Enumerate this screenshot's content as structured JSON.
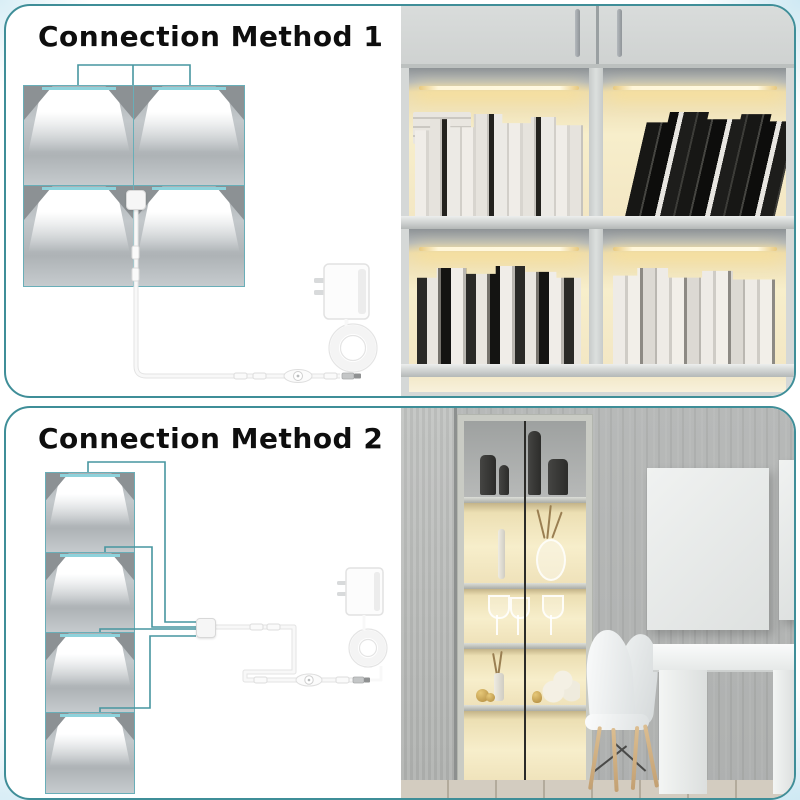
{
  "page": {
    "accent_teal": "#3f8e98",
    "wire_teal": "#4796a0",
    "led_cyan": "#8ed2db",
    "warm_light": "#f7eecb",
    "title_color": "#0e0e0e"
  },
  "sections": [
    {
      "id": "method-1",
      "title": "Connection Method 1",
      "diagram": {
        "panel_count": 4,
        "arrangement": "2x2 grid",
        "components": [
          "light panel x4",
          "4-way splitter",
          "extension cable",
          "inline switch",
          "coiled cable",
          "wall power adapter"
        ]
      }
    },
    {
      "id": "method-2",
      "title": "Connection Method 2",
      "diagram": {
        "panel_count": 4,
        "arrangement": "vertical stack",
        "components": [
          "light panel x4",
          "4-way splitter",
          "extension cable",
          "inline switch",
          "coiled cable",
          "wall power adapter"
        ]
      }
    }
  ]
}
